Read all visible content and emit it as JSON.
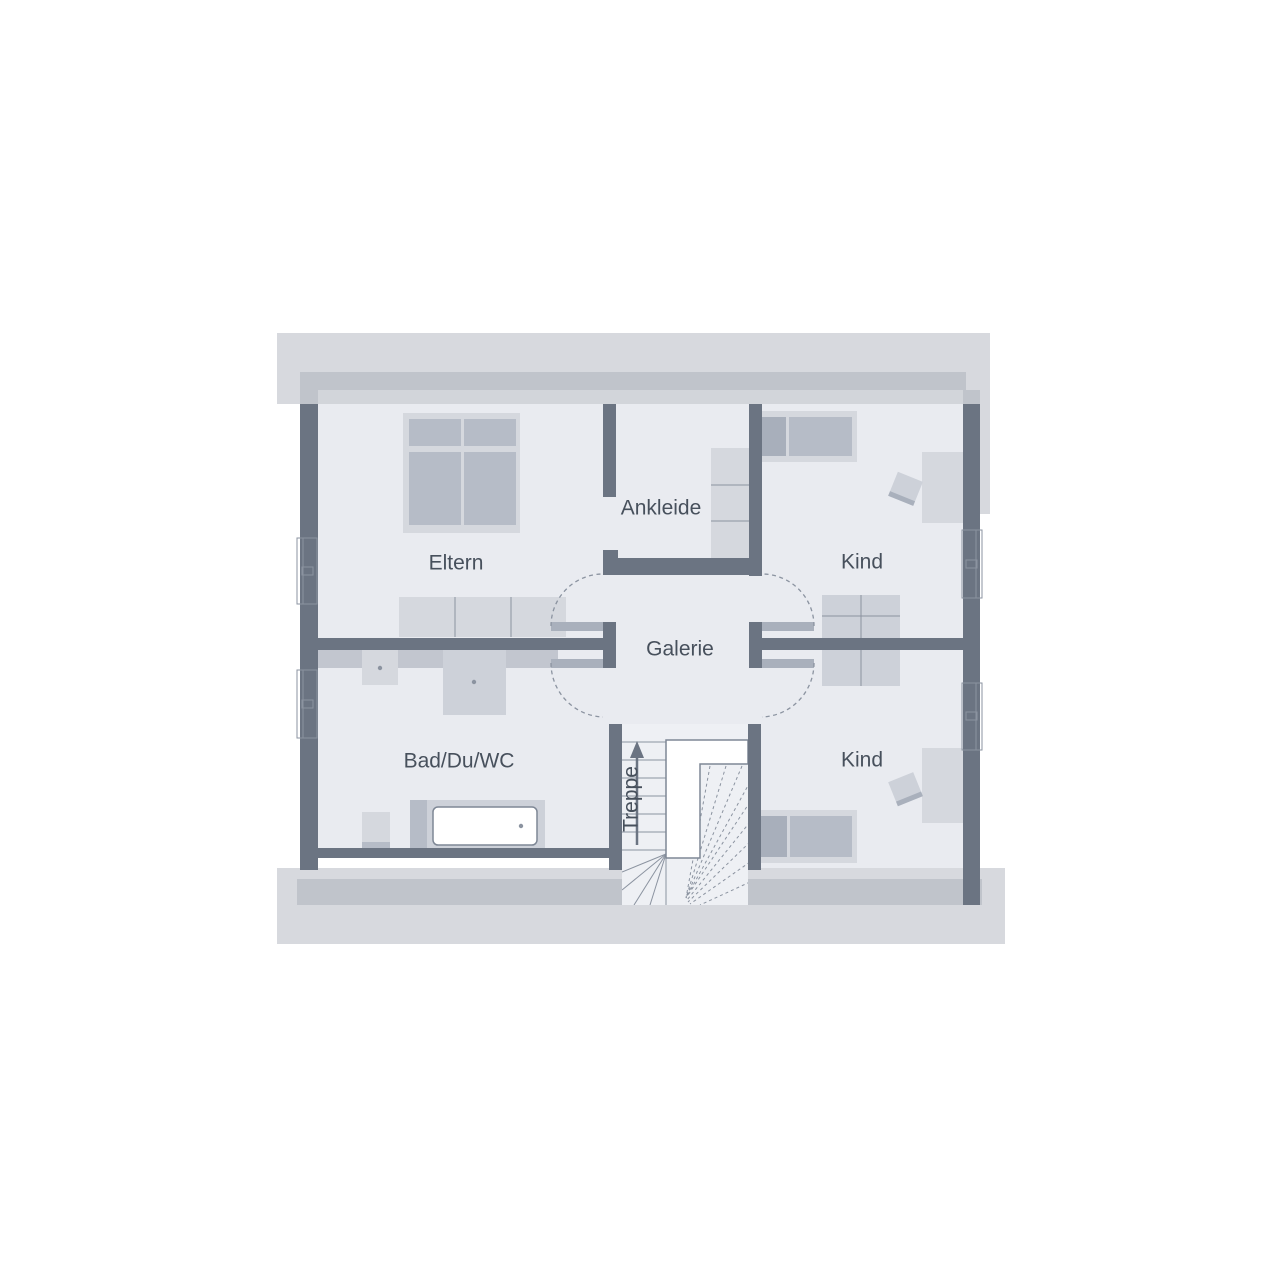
{
  "floorplan": {
    "type": "residential-floor-plan",
    "floor_labels": {
      "eltern": "Eltern",
      "ankleide": "Ankleide",
      "kind_top": "Kind",
      "galerie": "Galerie",
      "bad": "Bad/Du/WC",
      "kind_bottom": "Kind",
      "treppe": "Treppe"
    },
    "rooms": [
      {
        "id": "eltern",
        "label": "Eltern"
      },
      {
        "id": "ankleide",
        "label": "Ankleide"
      },
      {
        "id": "kind-top",
        "label": "Kind"
      },
      {
        "id": "galerie",
        "label": "Galerie"
      },
      {
        "id": "bad-du-wc",
        "label": "Bad/Du/WC"
      },
      {
        "id": "kind-bottom",
        "label": "Kind"
      },
      {
        "id": "treppe",
        "label": "Treppe"
      }
    ],
    "colors": {
      "background": "#ffffff",
      "roof_band_light": "#d7d9de",
      "roof_band_mid": "#c0c4cb",
      "roof_band_strip": "#d2d5da",
      "wall": "#6b7482",
      "room_fill": "#e9ebf0",
      "stair_fill": "#eef0f4",
      "furniture_light": "#d5d8de",
      "furniture_mid": "#cdd1d9",
      "furniture_dark": "#b6bcc7",
      "furniture_darker": "#a8afbb",
      "ledge": "#c2c6cf",
      "door_leaf": "#a9b0bc",
      "line": "#8b93a0",
      "label_text": "#47505c"
    }
  }
}
